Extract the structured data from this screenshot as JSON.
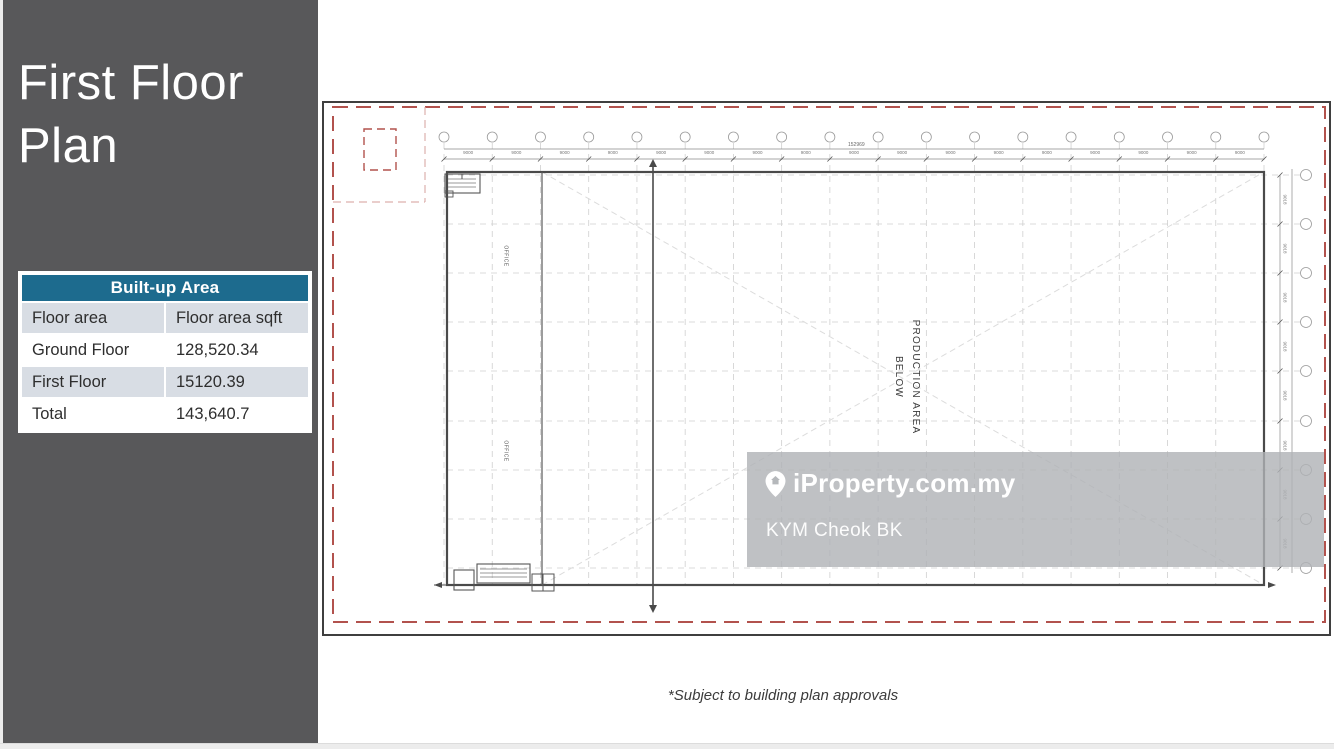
{
  "slide": {
    "title_line1": "First Floor",
    "title_line2": "Plan",
    "footnote": "*Subject to building plan approvals"
  },
  "table": {
    "header": "Built-up Area",
    "rows": [
      [
        "Floor area",
        "Floor area sqft"
      ],
      [
        "Ground Floor",
        "128,520.34"
      ],
      [
        "First Floor",
        "15120.39"
      ],
      [
        "Total",
        "143,640.7"
      ]
    ],
    "header_bg": "#1d6b8e",
    "alt_row_bg": "#d8dde4"
  },
  "plan": {
    "production_label_line1": "PRODUCTION AREA",
    "production_label_line2": "BELOW",
    "office_label": "OFFICE",
    "top_dim_segment": "9000",
    "top_dim_total": "152969",
    "side_dim_segment": "9018",
    "top_grid_count": 18,
    "side_grid_count": 9,
    "boundary_color": "#b2524d"
  },
  "watermark": {
    "brand": "iProperty.com.my",
    "agent": "KYM Cheok BK",
    "pin_icon": "map-pin-icon"
  }
}
